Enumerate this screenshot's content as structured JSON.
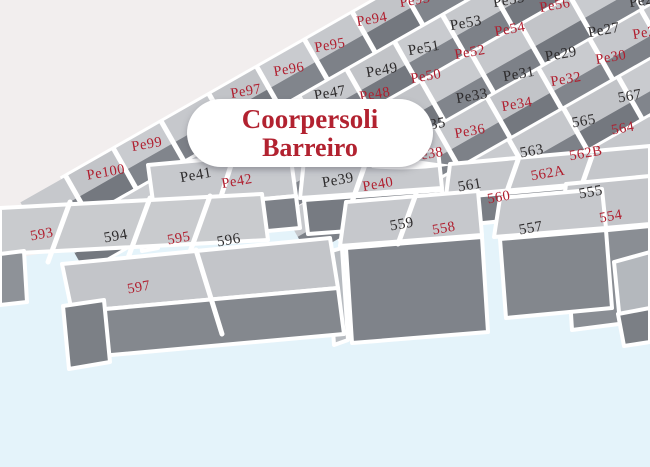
{
  "map": {
    "callout": {
      "line1": "Coorpersoli",
      "line2": "Barreiro"
    },
    "colors": {
      "ground": "#f2eeee",
      "water": "#e4f3fa",
      "label_red": "#b01e2e",
      "label_dark": "#2d2b2c",
      "callout_text": "#b22230",
      "block_top": "#c6c8cc",
      "block_side": "#7d8188",
      "separator": "#ffffff"
    },
    "labels": [
      {
        "text": "Pe93",
        "x": 415,
        "y": 1,
        "c": "red"
      },
      {
        "text": "Pe94",
        "x": 372,
        "y": 20,
        "c": "red"
      },
      {
        "text": "Pe95",
        "x": 330,
        "y": 46,
        "c": "red"
      },
      {
        "text": "Pe96",
        "x": 289,
        "y": 70,
        "c": "red"
      },
      {
        "text": "Pe97",
        "x": 246,
        "y": 92,
        "c": "red"
      },
      {
        "text": "Pe99",
        "x": 147,
        "y": 145,
        "c": "red"
      },
      {
        "text": "Pe100",
        "x": 106,
        "y": 173,
        "c": "red"
      },
      {
        "text": "Pe55",
        "x": 509,
        "y": 1,
        "c": "dark"
      },
      {
        "text": "Pe53",
        "x": 466,
        "y": 24,
        "c": "dark"
      },
      {
        "text": "Pe51",
        "x": 424,
        "y": 49,
        "c": "dark"
      },
      {
        "text": "Pe49",
        "x": 382,
        "y": 71,
        "c": "dark"
      },
      {
        "text": "Pe47",
        "x": 330,
        "y": 94,
        "c": "dark"
      },
      {
        "text": "Pe48",
        "x": 375,
        "y": 95,
        "c": "red"
      },
      {
        "text": "Pe56",
        "x": 555,
        "y": 6,
        "c": "red"
      },
      {
        "text": "Pe54",
        "x": 510,
        "y": 30,
        "c": "red"
      },
      {
        "text": "Pe52",
        "x": 470,
        "y": 53,
        "c": "red"
      },
      {
        "text": "Pe50",
        "x": 426,
        "y": 77,
        "c": "red"
      },
      {
        "text": "Pe25",
        "x": 645,
        "y": 1,
        "c": "dark"
      },
      {
        "text": "Pe27",
        "x": 604,
        "y": 31,
        "c": "dark"
      },
      {
        "text": "Pe29",
        "x": 561,
        "y": 55,
        "c": "dark"
      },
      {
        "text": "Pe31",
        "x": 519,
        "y": 75,
        "c": "dark"
      },
      {
        "text": "Pe33",
        "x": 472,
        "y": 97,
        "c": "dark"
      },
      {
        "text": "Pe35",
        "x": 430,
        "y": 126,
        "c": "dark"
      },
      {
        "text": "Pe28",
        "x": 648,
        "y": 33,
        "c": "red"
      },
      {
        "text": "Pe30",
        "x": 611,
        "y": 58,
        "c": "red"
      },
      {
        "text": "Pe32",
        "x": 566,
        "y": 80,
        "c": "red"
      },
      {
        "text": "Pe34",
        "x": 517,
        "y": 105,
        "c": "red"
      },
      {
        "text": "Pe36",
        "x": 470,
        "y": 132,
        "c": "red"
      },
      {
        "text": "Pe38",
        "x": 428,
        "y": 155,
        "c": "red"
      },
      {
        "text": "567",
        "x": 630,
        "y": 97,
        "c": "dark"
      },
      {
        "text": "565",
        "x": 584,
        "y": 122,
        "c": "dark"
      },
      {
        "text": "564",
        "x": 623,
        "y": 129,
        "c": "red"
      },
      {
        "text": "563",
        "x": 532,
        "y": 152,
        "c": "dark"
      },
      {
        "text": "562B",
        "x": 586,
        "y": 154,
        "c": "red"
      },
      {
        "text": "562A",
        "x": 548,
        "y": 174,
        "c": "red"
      },
      {
        "text": "561",
        "x": 470,
        "y": 186,
        "c": "dark"
      },
      {
        "text": "560",
        "x": 499,
        "y": 198,
        "c": "red"
      },
      {
        "text": "555",
        "x": 591,
        "y": 193,
        "c": "dark"
      },
      {
        "text": "554",
        "x": 611,
        "y": 217,
        "c": "red"
      },
      {
        "text": "Pe41",
        "x": 196,
        "y": 176,
        "c": "dark"
      },
      {
        "text": "Pe42",
        "x": 237,
        "y": 182,
        "c": "red"
      },
      {
        "text": "Pe39",
        "x": 338,
        "y": 181,
        "c": "dark"
      },
      {
        "text": "Pe40",
        "x": 378,
        "y": 185,
        "c": "red"
      },
      {
        "text": "559",
        "x": 402,
        "y": 225,
        "c": "dark"
      },
      {
        "text": "558",
        "x": 444,
        "y": 229,
        "c": "red"
      },
      {
        "text": "557",
        "x": 531,
        "y": 229,
        "c": "dark"
      },
      {
        "text": "593",
        "x": 42,
        "y": 235,
        "c": "red"
      },
      {
        "text": "594",
        "x": 116,
        "y": 237,
        "c": "dark"
      },
      {
        "text": "595",
        "x": 179,
        "y": 239,
        "c": "red"
      },
      {
        "text": "596",
        "x": 229,
        "y": 241,
        "c": "dark"
      },
      {
        "text": "597",
        "x": 139,
        "y": 288,
        "c": "red"
      }
    ]
  }
}
